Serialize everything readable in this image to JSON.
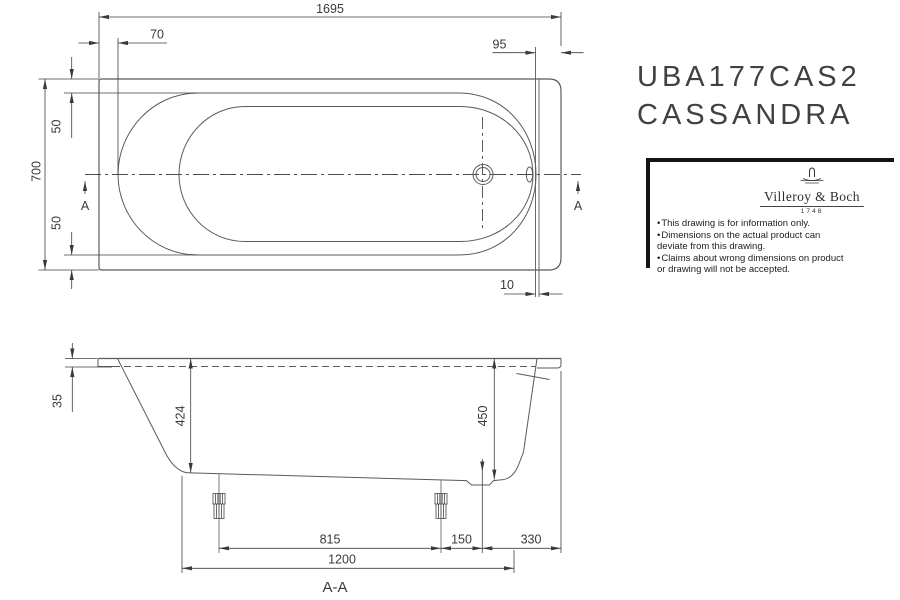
{
  "drawing": {
    "product_code": "UBA177CAS2",
    "product_name": "CASSANDRA",
    "brand": {
      "name": "Villeroy & Boch",
      "year": "1748",
      "notes": [
        "This drawing is for information only.",
        "Dimensions on the actual product can deviate from this drawing.",
        "Claims about wrong dimensions on product or drawing will not be accepted."
      ]
    },
    "top_view": {
      "overall_length": "1695",
      "left_offset": "70",
      "right_offset": "95",
      "overall_width": "700",
      "rim_top": "50",
      "rim_bottom": "50",
      "wall_gap": "10",
      "section_left": "A",
      "section_right": "A"
    },
    "side_view": {
      "rim_height": "35",
      "inner_depth": "424",
      "outer_height": "450",
      "feet_spacing": "815",
      "foot_to_drain": "150",
      "drain_to_edge": "330",
      "feet_span": "1200",
      "section_label": "A-A"
    },
    "colors": {
      "line": "#5a5a5a",
      "dim_line": "#3f3f3f",
      "text": "#3a3a3a",
      "frame": "#141414"
    }
  }
}
